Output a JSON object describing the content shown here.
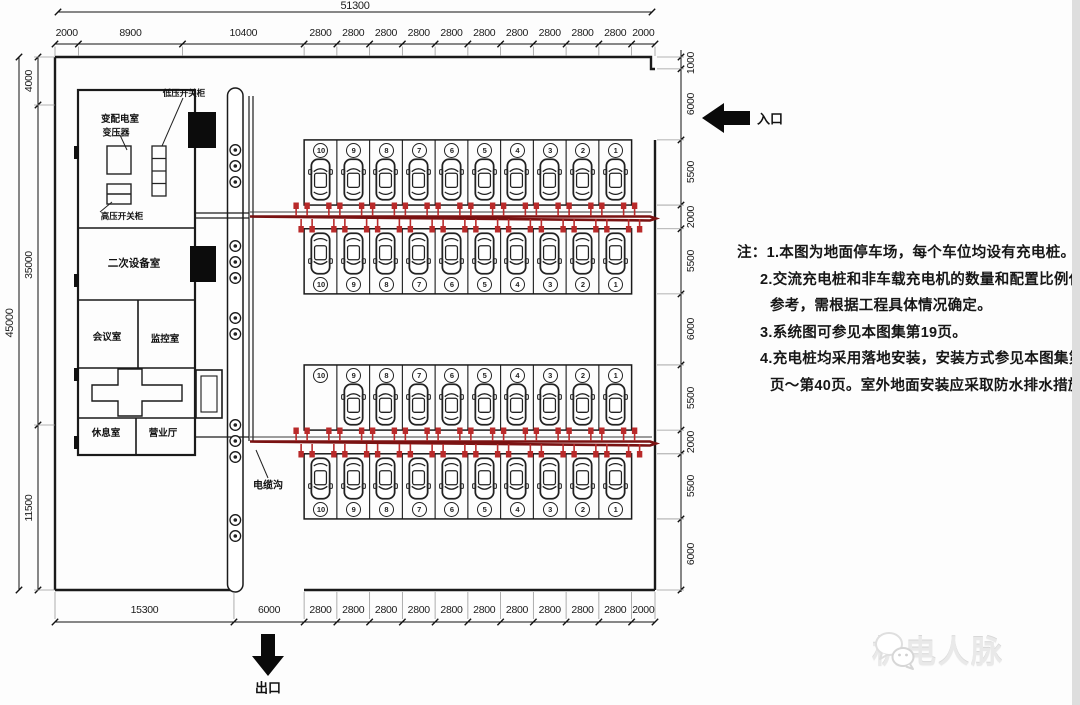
{
  "dim_chains": {
    "top_total": "51300",
    "top": [
      "2000",
      "8900",
      "10400",
      "2800",
      "2800",
      "2800",
      "2800",
      "2800",
      "2800",
      "2800",
      "2800",
      "2800",
      "2800",
      "2000"
    ],
    "bottom": [
      "15300",
      "6000",
      "2800",
      "2800",
      "2800",
      "2800",
      "2800",
      "2800",
      "2800",
      "2800",
      "2800",
      "2800",
      "2000"
    ],
    "left_total": "45000",
    "left": [
      "4000",
      "35000",
      "11500"
    ],
    "right": [
      "1000",
      "6000",
      "5500",
      "2000",
      "5500",
      "6000",
      "5500",
      "2000",
      "5500",
      "6000"
    ]
  },
  "site": {
    "entrance_label": "入口",
    "exit_label": "出口",
    "cable_trench_label": "电缆沟"
  },
  "building": {
    "rooms": {
      "power_dist": "变配电室",
      "transformer": "变压器",
      "hv_switchgear": "高压开关柜",
      "lv_switchgear": "低压开关柜",
      "secondary_equip": "二次设备室",
      "meeting": "会议室",
      "monitoring": "监控室",
      "rest": "休息室",
      "business_hall": "营业厅"
    }
  },
  "parking": {
    "stall_numbers": [
      "10",
      "9",
      "8",
      "7",
      "6",
      "5",
      "4",
      "3",
      "2",
      "1"
    ],
    "rows": [
      {
        "name": "row-1",
        "circle": "top",
        "facing": "up",
        "cars": [
          1,
          1,
          1,
          1,
          1,
          1,
          1,
          1,
          1,
          1
        ]
      },
      {
        "name": "row-2",
        "circle": "bottom",
        "facing": "down",
        "cars": [
          1,
          1,
          1,
          1,
          1,
          1,
          1,
          1,
          1,
          1
        ]
      },
      {
        "name": "row-3",
        "circle": "top",
        "facing": "up",
        "cars": [
          0,
          1,
          1,
          1,
          1,
          1,
          1,
          1,
          1,
          1
        ]
      },
      {
        "name": "row-4",
        "circle": "bottom",
        "facing": "down",
        "cars": [
          1,
          1,
          1,
          1,
          1,
          1,
          1,
          1,
          1,
          1
        ]
      }
    ]
  },
  "notes": {
    "lines": [
      {
        "indent": 0,
        "text": "注：1.本图为地面停车场，每个车位均设有充电桩。"
      },
      {
        "indent": 1,
        "text": "2.交流充电桩和非车载充电机的数量和配置比例仅为"
      },
      {
        "indent": 2,
        "text": "参考，需根据工程具体情况确定。"
      },
      {
        "indent": 1,
        "text": "3.系统图可参见本图集第19页。"
      },
      {
        "indent": 1,
        "text": "4.充电桩均采用落地安装，安装方式参见本图集第39"
      },
      {
        "indent": 2,
        "text": "页～第40页。室外地面安装应采取防水排水措施。"
      }
    ]
  },
  "watermark": {
    "text": "机电人脉"
  },
  "colors": {
    "drawing": "#1a1a1a",
    "cable_line": "#7a1212",
    "pile": "#b92a2a"
  }
}
